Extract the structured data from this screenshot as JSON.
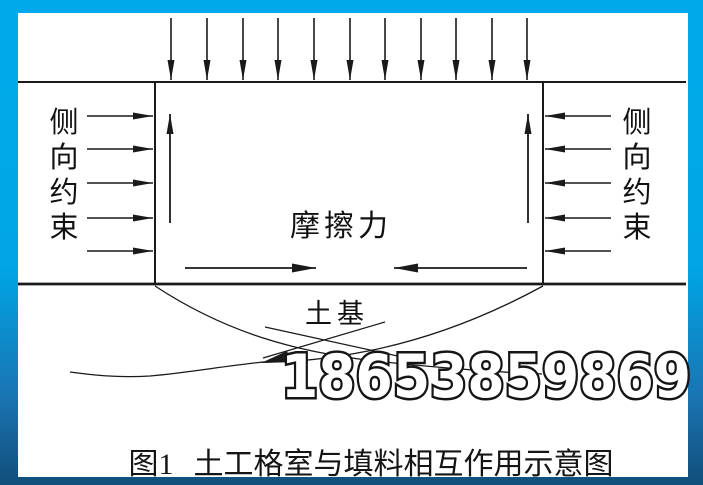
{
  "diagram": {
    "caption": {
      "prefix": "图1",
      "title": "土工格室与填料相互作用示意图"
    },
    "labels": {
      "friction": "摩擦力",
      "subgrade": "土基",
      "left_constraint": {
        "chars": [
          "侧",
          "向",
          "约",
          "束"
        ]
      },
      "right_constraint": {
        "chars": [
          "侧",
          "向",
          "约",
          "束"
        ]
      }
    },
    "watermark": "18653859869",
    "arrows": {
      "top_load_count": 11,
      "left_constraint_count": 5,
      "right_constraint_count": 5,
      "internal_up_count": 2,
      "internal_friction_count": 2
    },
    "colors": {
      "frame_top": "#00aaea",
      "frame_bottom": "#114e7b",
      "line": "#1a1a1a",
      "paper": "#ffffff",
      "watermark_fill": "#ffffff",
      "watermark_outline": "#151515"
    }
  }
}
